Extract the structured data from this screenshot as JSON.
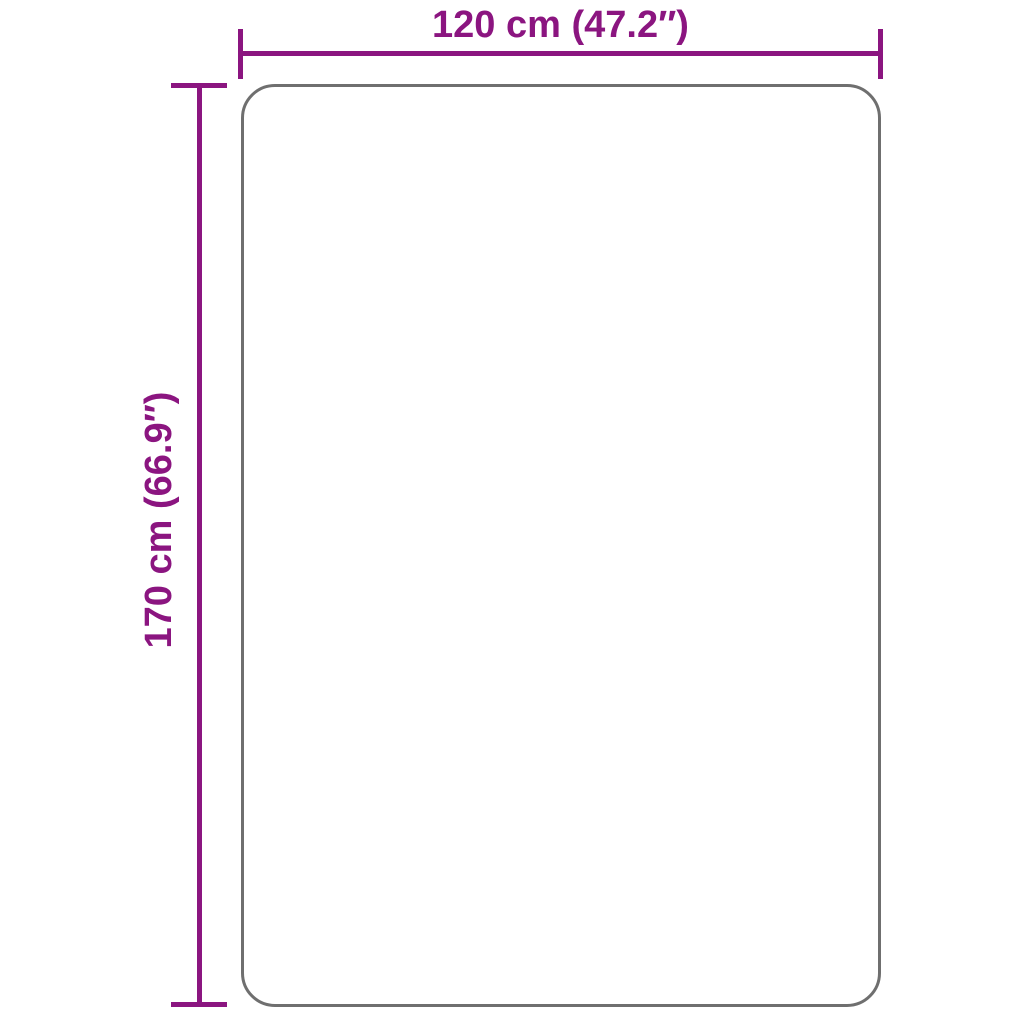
{
  "diagram": {
    "width_label": "120 cm (47.2″)",
    "height_label": "170 cm (66.9″)",
    "colors": {
      "dimension_accent": "#8B1580",
      "item_outline": "#6F6F6F",
      "background": "#FFFFFF"
    }
  }
}
